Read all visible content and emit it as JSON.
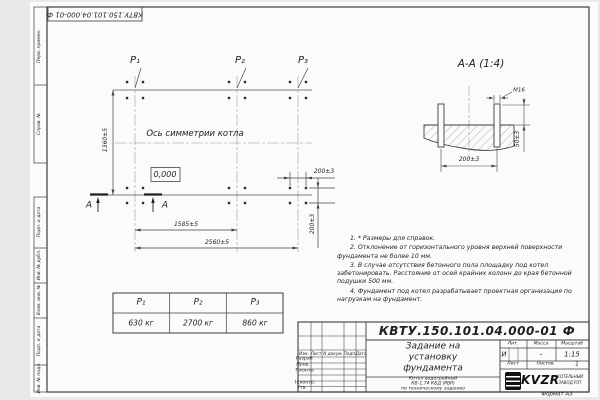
{
  "frame": {
    "stamp_top": "КВТУ.150.101.04.000-01 Ф",
    "format_label": "Формат А3",
    "sidebar_top": [
      "Перв. примен.",
      "Справ. №"
    ],
    "sidebar_bottom": [
      "Подп. и дата",
      "Инв. № дубл.",
      "Взам. инв. №",
      "Подп. и дата",
      "Инв. № подл."
    ]
  },
  "plan": {
    "load_labels": [
      "Р₁",
      "Р₂",
      "Р₃"
    ],
    "axis_label": "Ось симметрии котла",
    "elevation": "0,000",
    "dim_height": "1360±5",
    "dim_span1": "1585±5",
    "dim_span2": "2560±5",
    "dim_bolt_x": "200±3",
    "dim_bolt_y": "200±3",
    "section_letter": "А"
  },
  "section": {
    "title": "А-А (1:4)",
    "thread": "М16",
    "dim_height": "50±3",
    "dim_spacing": "200±3"
  },
  "notes": [
    "1. * Размеры для справок.",
    "2. Отклонение от горизонтального уровня верхней поверхности фундамента не более 10 мм.",
    "3. В случае отсутствия бетонного пола площадку под котел забетонировать. Расстояние от осей крайних колонн до края бетонной подушки 500 мм.",
    "4. Фундамент под котел разрабатывает проектная организация по нагрузкам на фундамент."
  ],
  "load_table": {
    "headers": [
      "Р₁",
      "Р₂",
      "Р₃"
    ],
    "values": [
      "630 кг",
      "2700 кг",
      "860 кг"
    ]
  },
  "title_block": {
    "doc_number": "КВТУ.150.101.04.000-01 Ф",
    "title_lines": [
      "Задание на",
      "установку",
      "фундамента"
    ],
    "subtitle_lines": [
      "Котел водогрейный",
      "КВ-1,74 КБД (РВР)",
      "по техническому заданию"
    ],
    "col_headers": [
      "Изм.",
      "Лист",
      "N докум.",
      "Подп.",
      "Дата"
    ],
    "row_labels": [
      "Разраб.",
      "Пров.",
      "Т.контр.",
      "Н.контр.",
      "Утв."
    ],
    "lit_header": "Лит.",
    "mass_header": "Масса",
    "scale_header": "Масштаб",
    "lit_value": "И",
    "mass_value": "-",
    "scale_value": "1:15",
    "sheet_label": "Лист",
    "sheets_label": "Листов",
    "sheets_value": "1",
    "company_name": "KVZR",
    "company_desc1": "КОТЕЛЬНЫЙ",
    "company_desc2": "ЗАВОД РЭТ"
  }
}
